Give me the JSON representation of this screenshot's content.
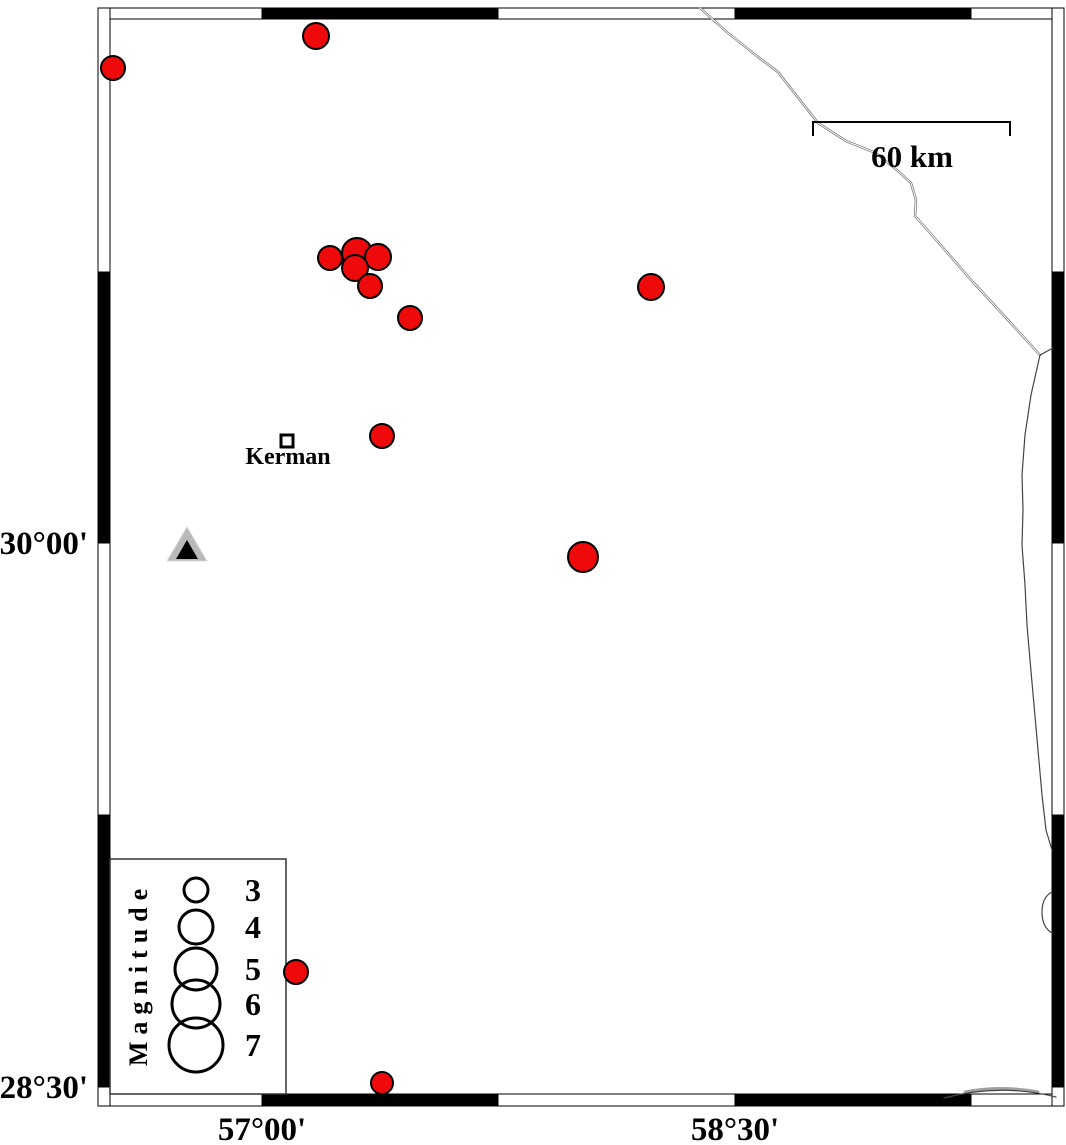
{
  "map": {
    "description": "Seismicity map around Kerman with earthquake epicenters sized by magnitude",
    "region": {
      "lon_min": 56.48,
      "lon_max": 59.51,
      "lat_min": 28.46,
      "lat_max": 31.44
    },
    "axis_labels": {
      "left": [
        {
          "text": "30°00'",
          "x": 88,
          "y": 554
        },
        {
          "text": "28°30'",
          "x": 88,
          "y": 1098
        }
      ],
      "bottom": [
        {
          "text": "57°00'",
          "x": 262,
          "y": 1140
        },
        {
          "text": "58°30'",
          "x": 735,
          "y": 1140
        }
      ]
    },
    "scale_bar": {
      "label": "60 km",
      "x1": 813,
      "x2": 1010,
      "y": 122,
      "tick_drop": 14,
      "label_x": 912,
      "label_y": 167
    },
    "city": {
      "name": "Kerman",
      "marker_x": 281,
      "marker_y": 435,
      "marker_size": 12,
      "label_x": 288,
      "label_y": 464
    },
    "station": {
      "kind": "seismic-station-triangle",
      "outer_points": "187,527 167,561 207,561",
      "inner_points": "187,540 176,559 198,559"
    },
    "earthquakes": [
      {
        "x": 316,
        "y": 36,
        "r": 13,
        "lon": 57.17,
        "lat": 31.4
      },
      {
        "x": 113,
        "y": 68,
        "r": 12,
        "lon": 56.53,
        "lat": 31.31
      },
      {
        "x": 330,
        "y": 258,
        "r": 12,
        "lon": 57.22,
        "lat": 30.79
      },
      {
        "x": 357,
        "y": 253,
        "r": 15,
        "lon": 57.3,
        "lat": 30.8
      },
      {
        "x": 378,
        "y": 257,
        "r": 13,
        "lon": 57.37,
        "lat": 30.79
      },
      {
        "x": 355,
        "y": 268,
        "r": 13,
        "lon": 57.3,
        "lat": 30.76
      },
      {
        "x": 370,
        "y": 286,
        "r": 12,
        "lon": 57.34,
        "lat": 30.71
      },
      {
        "x": 410,
        "y": 318,
        "r": 12,
        "lon": 57.47,
        "lat": 30.62
      },
      {
        "x": 651,
        "y": 287,
        "r": 13,
        "lon": 58.23,
        "lat": 30.71
      },
      {
        "x": 382,
        "y": 436,
        "r": 12,
        "lon": 57.38,
        "lat": 30.3
      },
      {
        "x": 583,
        "y": 557,
        "r": 15,
        "lon": 58.02,
        "lat": 29.96
      },
      {
        "x": 296,
        "y": 972,
        "r": 12,
        "lon": 57.11,
        "lat": 28.82
      },
      {
        "x": 382,
        "y": 1083,
        "r": 11,
        "lon": 57.38,
        "lat": 28.51
      }
    ],
    "legend": {
      "title": "Magnitude",
      "box": {
        "x": 110,
        "y": 859,
        "w": 176,
        "h": 235
      },
      "title_x": 141,
      "title_y": 974,
      "circle_x": 196,
      "label_x": 253,
      "entries": [
        {
          "magnitude": "3",
          "cy": 890,
          "r": 12
        },
        {
          "magnitude": "4",
          "cy": 927,
          "r": 17
        },
        {
          "magnitude": "5",
          "cy": 969,
          "r": 21
        },
        {
          "magnitude": "6",
          "cy": 1004,
          "r": 24
        },
        {
          "magnitude": "7",
          "cy": 1045,
          "r": 27
        }
      ]
    },
    "frame": {
      "outer": {
        "x": 98,
        "y": 8,
        "w": 966,
        "h": 1098
      },
      "inner": {
        "x": 110,
        "y": 19,
        "w": 942,
        "h": 1075
      },
      "top": {
        "y": 8,
        "h": 11,
        "segments": [
          [
            98,
            262,
            "#ffffff"
          ],
          [
            262,
            498,
            "#000000"
          ],
          [
            498,
            735,
            "#ffffff"
          ],
          [
            735,
            971,
            "#000000"
          ],
          [
            971,
            1064,
            "#ffffff"
          ]
        ]
      },
      "bottom": {
        "y": 1094,
        "h": 12,
        "segments": [
          [
            98,
            262,
            "#ffffff"
          ],
          [
            262,
            498,
            "#000000"
          ],
          [
            498,
            735,
            "#ffffff"
          ],
          [
            735,
            971,
            "#000000"
          ],
          [
            971,
            1064,
            "#ffffff"
          ]
        ]
      },
      "left": {
        "x": 98,
        "w": 12,
        "segments": [
          [
            8,
            272,
            "#ffffff"
          ],
          [
            272,
            543,
            "#000000"
          ],
          [
            543,
            815,
            "#ffffff"
          ],
          [
            815,
            1087,
            "#000000"
          ],
          [
            1087,
            1106,
            "#ffffff"
          ]
        ]
      },
      "right": {
        "x": 1052,
        "w": 12,
        "segments": [
          [
            8,
            272,
            "#ffffff"
          ],
          [
            272,
            543,
            "#000000"
          ],
          [
            543,
            815,
            "#ffffff"
          ],
          [
            815,
            1087,
            "#000000"
          ],
          [
            1087,
            1106,
            "#ffffff"
          ]
        ]
      }
    },
    "roads": [
      {
        "name": "road-northeast",
        "d": "M700,8 L728,33 L758,57 L778,72 L800,100 L818,123 L846,141 L876,153 L898,171 L911,183 L916,200 L915,216 L938,242 L972,281 L1008,320 L1040,355",
        "color": "#6e6e6e",
        "width": 2.4,
        "casing": true
      },
      {
        "name": "road-branch-east",
        "d": "M1040,355 L1053,348",
        "color": "#444444",
        "width": 1.2,
        "casing": false
      },
      {
        "name": "boundary-east",
        "d": "M1040,355 L1031,395 L1025,435 L1022,475 L1023,510 L1022,545 L1025,585 L1027,625 L1030,660 L1034,705 L1038,750 L1042,795 L1046,830 L1052,850",
        "color": "#444444",
        "width": 1.2,
        "casing": false
      },
      {
        "name": "boundary-loop-east",
        "d": "M1052,892 C1044,896 1042,904 1042,912 C1042,921 1045,929 1052,933",
        "color": "#444444",
        "width": 1.2,
        "casing": false
      },
      {
        "name": "road-southeast-gray",
        "d": "M965,1092 Q1000,1085 1038,1092",
        "color": "#a0a0a0",
        "width": 3,
        "casing": false
      },
      {
        "name": "road-southeast",
        "d": "M944,1098 Q1000,1083 1056,1097",
        "color": "#444444",
        "width": 1.2,
        "casing": false
      }
    ],
    "colors": {
      "earthquake_fill": "#ee0a0a",
      "earthquake_stroke": "#000000",
      "station_fill": "#b9b9b9",
      "station_inner": "#000000",
      "frame_stroke": "#000000"
    }
  }
}
